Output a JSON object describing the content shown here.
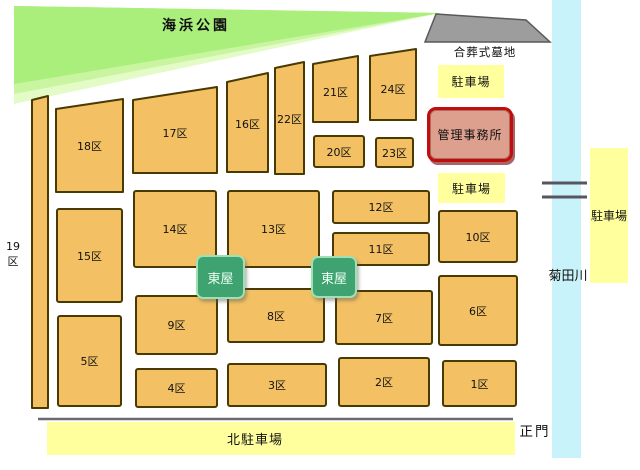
{
  "map": {
    "park": {
      "label": "海浜公園"
    },
    "communal_grave": {
      "label": "合葬式墓地"
    },
    "office": {
      "label": "管理事務所"
    },
    "parking_top": {
      "label": "駐車場"
    },
    "parking_middle": {
      "label": "駐車場"
    },
    "parking_east": {
      "label": "駐車場"
    },
    "parking_north": {
      "label": "北駐車場"
    },
    "main_gate": {
      "label": "正門"
    },
    "river": {
      "label": "菊田川"
    },
    "gazebo_west": {
      "label": "東屋"
    },
    "gazebo_east": {
      "label": "東屋"
    },
    "sections": [
      {
        "id": 1,
        "label": "1区"
      },
      {
        "id": 2,
        "label": "2区"
      },
      {
        "id": 3,
        "label": "3区"
      },
      {
        "id": 4,
        "label": "4区"
      },
      {
        "id": 5,
        "label": "5区"
      },
      {
        "id": 6,
        "label": "6区"
      },
      {
        "id": 7,
        "label": "7区"
      },
      {
        "id": 8,
        "label": "8区"
      },
      {
        "id": 9,
        "label": "9区"
      },
      {
        "id": 10,
        "label": "10区"
      },
      {
        "id": 11,
        "label": "11区"
      },
      {
        "id": 12,
        "label": "12区"
      },
      {
        "id": 13,
        "label": "13区"
      },
      {
        "id": 14,
        "label": "14区"
      },
      {
        "id": 15,
        "label": "15区"
      },
      {
        "id": 16,
        "label": "16区"
      },
      {
        "id": 17,
        "label": "17区"
      },
      {
        "id": 18,
        "label": "18区"
      },
      {
        "id": 19,
        "label": "19区"
      },
      {
        "id": 20,
        "label": "20区"
      },
      {
        "id": 21,
        "label": "21区"
      },
      {
        "id": 22,
        "label": "22区"
      },
      {
        "id": 23,
        "label": "23区"
      },
      {
        "id": 24,
        "label": "24区"
      }
    ]
  },
  "colors": {
    "section_fill": "#f3c163",
    "section_border": "#493a02",
    "park_green": "#aaee7c",
    "park_green_mid": "#c9f5a0",
    "park_green_light": "#e3fbc6",
    "parking_yellow": "#ffff9e",
    "river_blue": "#c9f3fa",
    "office_fill": "#dda08f",
    "office_border": "#c00d0d",
    "gazebo_fill": "#3fa271",
    "gazebo_border": "#9fe0b4",
    "grave_gray": "#9d9d9d",
    "boundary_gray": "#6a6a74",
    "text_color": "#111111"
  }
}
